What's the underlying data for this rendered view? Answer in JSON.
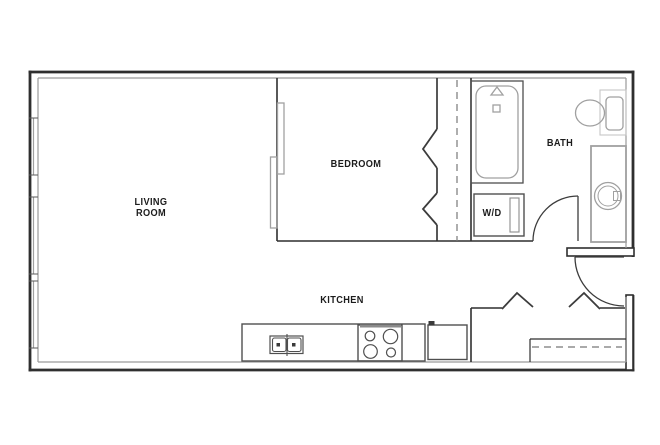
{
  "plan": {
    "title": "Studio apartment floor plan",
    "labels": {
      "living_room": "LIVING ROOM",
      "bedroom": "BEDROOM",
      "bath": "BATH",
      "washer_dryer": "W/D",
      "kitchen": "KITCHEN"
    },
    "colors": {
      "wall": "#2f2f2f",
      "inner_wall": "#9a9a9a",
      "fixture": "#a0a0a0",
      "appliance": "#4f4f4f",
      "door": "#3c3c3c",
      "dashed": "#787878",
      "window_tick": "#5a5a5a",
      "text": "#1c1c1c",
      "background": "#ffffff"
    },
    "fixtures": [
      "bathtub",
      "toilet",
      "vanity-sink",
      "washer-dryer-unit",
      "kitchen-sink",
      "stove",
      "refrigerator",
      "bedroom-sliding-door",
      "bedroom-closet-bifold-doors",
      "entry-closet-bifold-doors",
      "entry-closet-rod",
      "bath-door-swing",
      "entry-door-swing",
      "left-wall-windows"
    ]
  }
}
